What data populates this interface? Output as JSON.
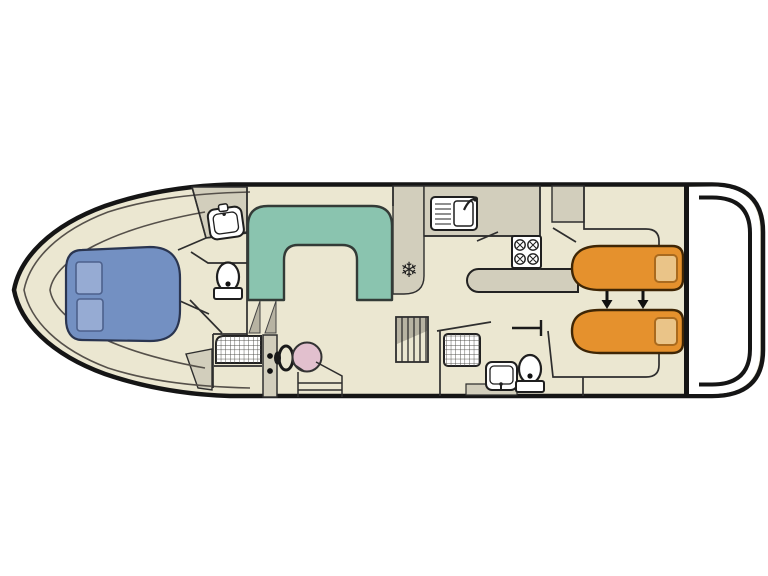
{
  "page": {
    "background": "#ffffff",
    "description_label": "boat-deck-floorplan"
  },
  "colors": {
    "hull_outline": "#151515",
    "interior": "#ebe7d1",
    "wet_area": "#d2cebc",
    "step_gray": "#b7b3a2",
    "deck_white": "#ffffff",
    "wall": "#2e2e2e",
    "icon_stroke": "#1f1f1f",
    "bed_blue": "#7390c2",
    "pillow_blue": "#96abd3",
    "bed_blue_outline": "#2a3550",
    "dinette_teal": "#8ac4af",
    "dinette_outline": "#333b37",
    "bed_orange": "#e5912d",
    "pillow_orange": "#eac488",
    "bed_orange_outline": "#3f2605",
    "helm_seat_pink": "#e2c0ce",
    "fixture_white": "#ffffff"
  },
  "symbols": {
    "fridge": "❄"
  },
  "inventory": {
    "rooms": [
      {
        "name": "bow-double-cabin"
      },
      {
        "name": "forward-bathroom"
      },
      {
        "name": "saloon-dinette"
      },
      {
        "name": "helm-station"
      },
      {
        "name": "galley"
      },
      {
        "name": "forward-shower-room"
      },
      {
        "name": "rear-bathroom"
      },
      {
        "name": "rear-twin-cabin"
      },
      {
        "name": "stern-deck"
      }
    ],
    "items": [
      {
        "name": "double-bed-forward",
        "color_key": "bed_blue"
      },
      {
        "name": "washbasin-forward"
      },
      {
        "name": "toilet-forward"
      },
      {
        "name": "shower-forward"
      },
      {
        "name": "u-shaped-dinette",
        "color_key": "dinette_teal"
      },
      {
        "name": "entry-steps"
      },
      {
        "name": "steering-wheel"
      },
      {
        "name": "helm-seat",
        "color_key": "helm_seat_pink"
      },
      {
        "name": "refrigerator-snowflake"
      },
      {
        "name": "galley-sink"
      },
      {
        "name": "stove-4-burner"
      },
      {
        "name": "galley-counter-bar"
      },
      {
        "name": "companionway-stairs"
      },
      {
        "name": "shower-rear"
      },
      {
        "name": "washbasin-rear"
      },
      {
        "name": "toilet-rear"
      },
      {
        "name": "single-bed-rear-top",
        "color_key": "bed_orange"
      },
      {
        "name": "single-bed-rear-bottom",
        "color_key": "bed_orange"
      },
      {
        "name": "sliding-bed-arrows"
      },
      {
        "name": "wardrobe-forward"
      },
      {
        "name": "wardrobe-rear"
      }
    ]
  }
}
